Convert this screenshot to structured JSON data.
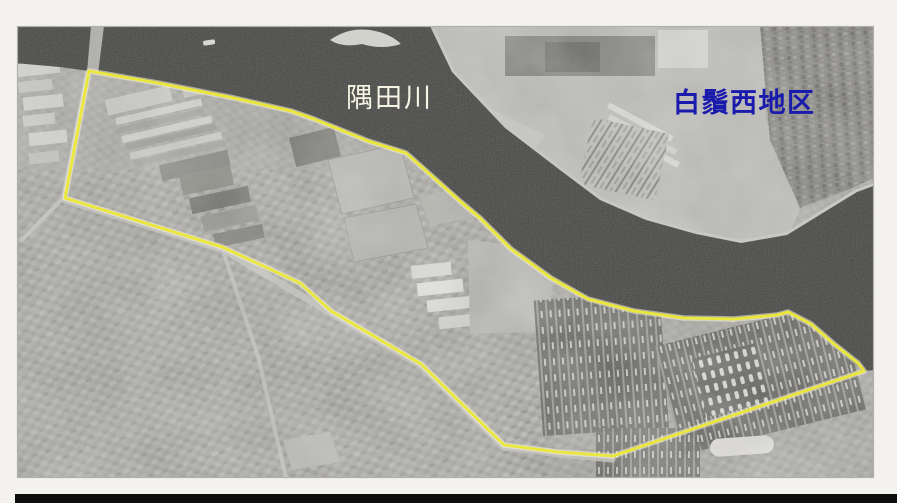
{
  "scan": {
    "frame_color": "#f3f2ee",
    "bottom_bar_color": "#0d0d0d"
  },
  "photo": {
    "type": "aerial-photograph",
    "land": {
      "base_color": "#a3a29e"
    },
    "river": {
      "name_label": "隅田川",
      "water_color": "#3a3b39",
      "path": "M 14,26 L 430,26 L 452,72 L 505,128 L 560,170 L 600,200 L 646,220 L 696,234 L 741,243 L 787,235 L 826,211 L 857,192 L 876,185 L 876,370 L 862,371 L 834,344 L 811,324 L 788,312 L 777,315 L 734,319 L 684,318 L 634,311 L 588,299 L 551,278 L 511,249 L 480,218 L 461,202 L 433,177 L 406,153 L 368,141 L 314,119 L 291,111 L 234,98 L 158,83 L 89,71 L 60,67 L 14,63 Z"
    },
    "labels": {
      "river": {
        "text": "隅田川",
        "color": "#f7f4e4"
      },
      "district": {
        "text": "白鬚西地区",
        "color": "#1a1aad"
      }
    },
    "boundary": {
      "color": "#ebe73b",
      "halo_color": "#f7f6da",
      "points": "89,71 158,83 234,98 291,111 314,119 368,141 406,153 433,177 461,202 480,218 511,249 551,278 588,299 634,311 684,318 734,319 777,315 788,312 811,324 834,344 858,363 864,371 613,456 558,452 504,445 421,364 331,311 300,283 222,247 65,198"
    }
  }
}
